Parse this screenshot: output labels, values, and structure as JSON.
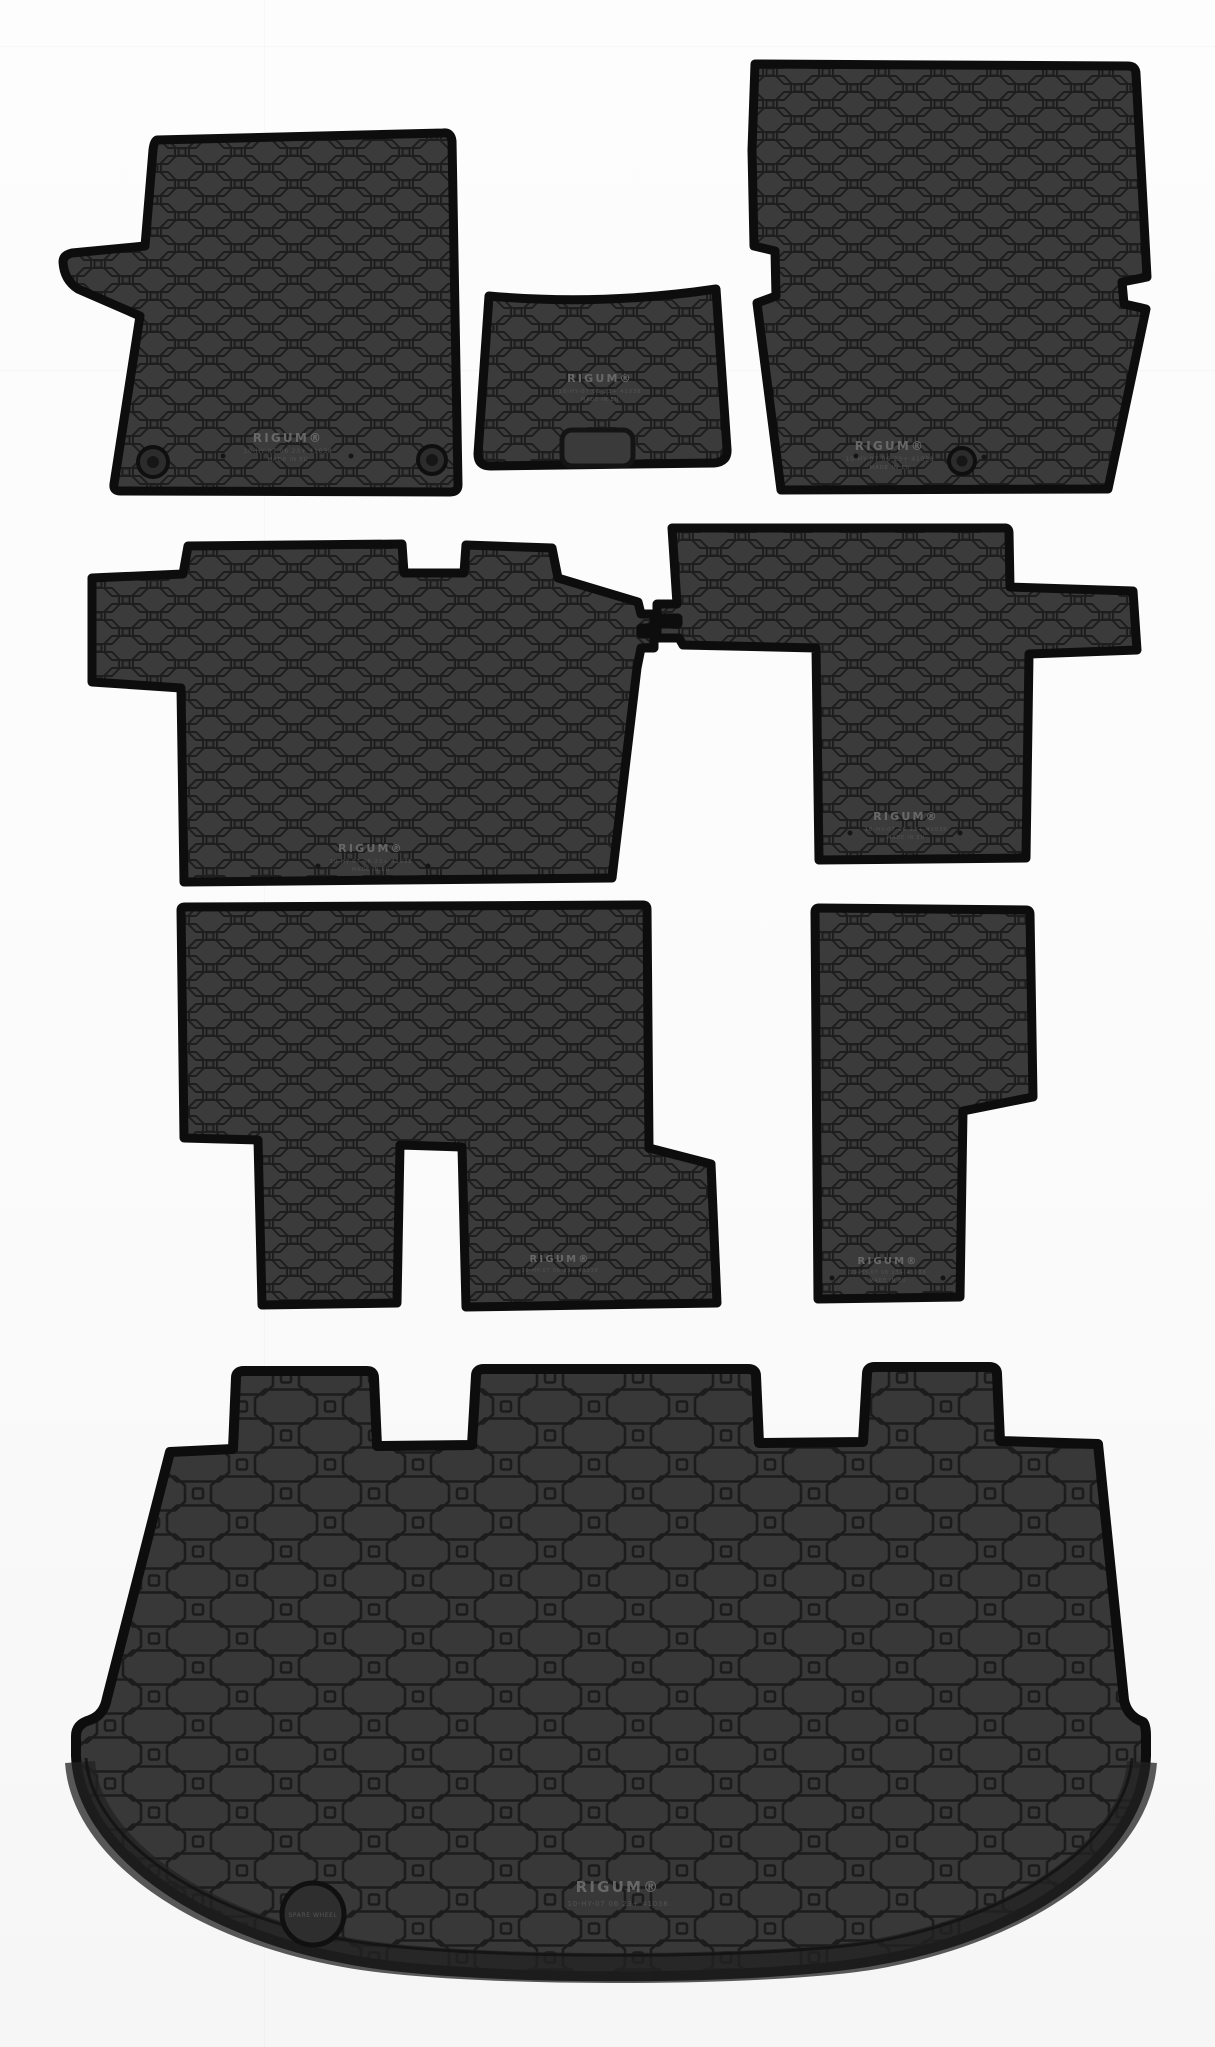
{
  "scene": {
    "description": "Product photo of an 8-piece black rubber car floor mat set on a white studio background",
    "background_color": "#fbfbfb"
  },
  "colors": {
    "mat_surface": "#3b3b3b",
    "trunk_surface": "#383838",
    "mat_rim": "#0d0d0d",
    "pattern_line": "#1e1e1e",
    "emboss_bright": "#6f6f6f",
    "emboss_dim": "#575757"
  },
  "branding": {
    "brand": "RIGUM®",
    "part_line": "10-HY-07 06 23+ 41038",
    "origin_line": "MADE IN EU",
    "spare_wheel_label": "SPARE WHEEL"
  },
  "mats": [
    {
      "id": "front-left-mat",
      "label": "Front left (driver) mat with heel pad"
    },
    {
      "id": "centre-tunnel-mat",
      "label": "Centre tunnel mat"
    },
    {
      "id": "front-right-mat",
      "label": "Front right (passenger) mat"
    },
    {
      "id": "second-row-left-mat",
      "label": "Second row left mat with connector hooks"
    },
    {
      "id": "second-row-right-mat",
      "label": "Second row right mat with connector hooks"
    },
    {
      "id": "third-row-left-mat",
      "label": "Third row left mat with twin legs"
    },
    {
      "id": "third-row-right-mat",
      "label": "Third row right stepped mat"
    },
    {
      "id": "trunk-tray-mat",
      "label": "Trunk boot tray with three seat-back tabs and spare wheel cap"
    }
  ]
}
